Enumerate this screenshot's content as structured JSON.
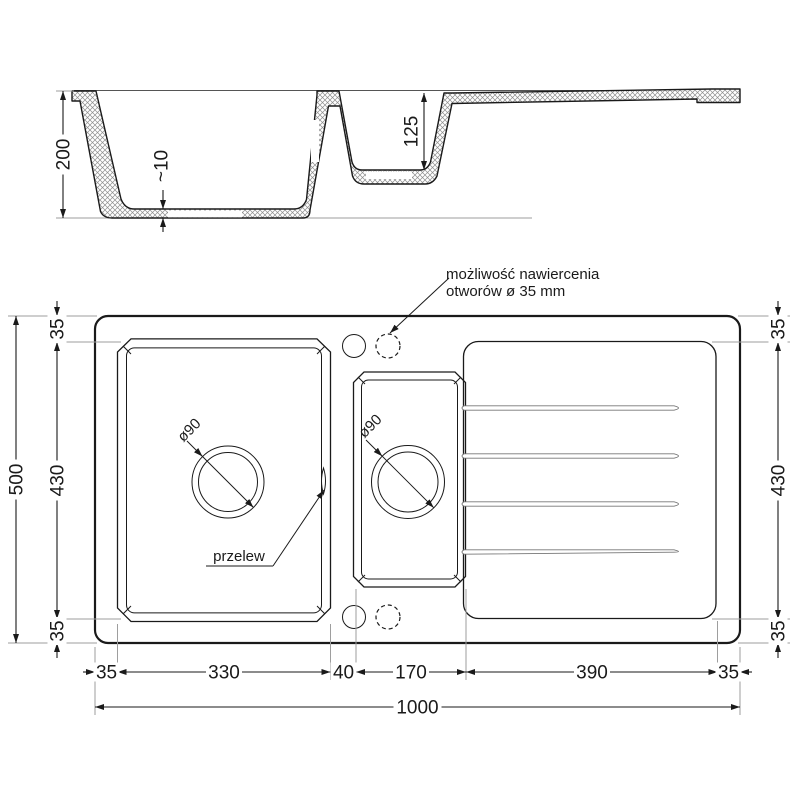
{
  "drawing": {
    "section": {
      "depth_main": "200",
      "bottom_thickness": "~10",
      "depth_small": "125"
    },
    "plan": {
      "annotation": {
        "line1": "możliwość nawiercenia",
        "line2": "otworów ø 35 mm"
      },
      "overflow_label": "przelew",
      "drain_main_label": "ø90",
      "drain_small_label": "ø90",
      "height_total": "500",
      "left": {
        "top": "35",
        "middle": "430",
        "bottom": "35"
      },
      "right": {
        "top": "35",
        "middle": "430",
        "bottom": "35"
      },
      "widths": [
        "35",
        "330",
        "40",
        "170",
        "390",
        "35"
      ],
      "width_total": "1000"
    },
    "colors": {
      "line": "#1a1a1a",
      "ext": "#9e9e9e",
      "hatch": "#8f8f8f",
      "bg": "#ffffff"
    }
  }
}
